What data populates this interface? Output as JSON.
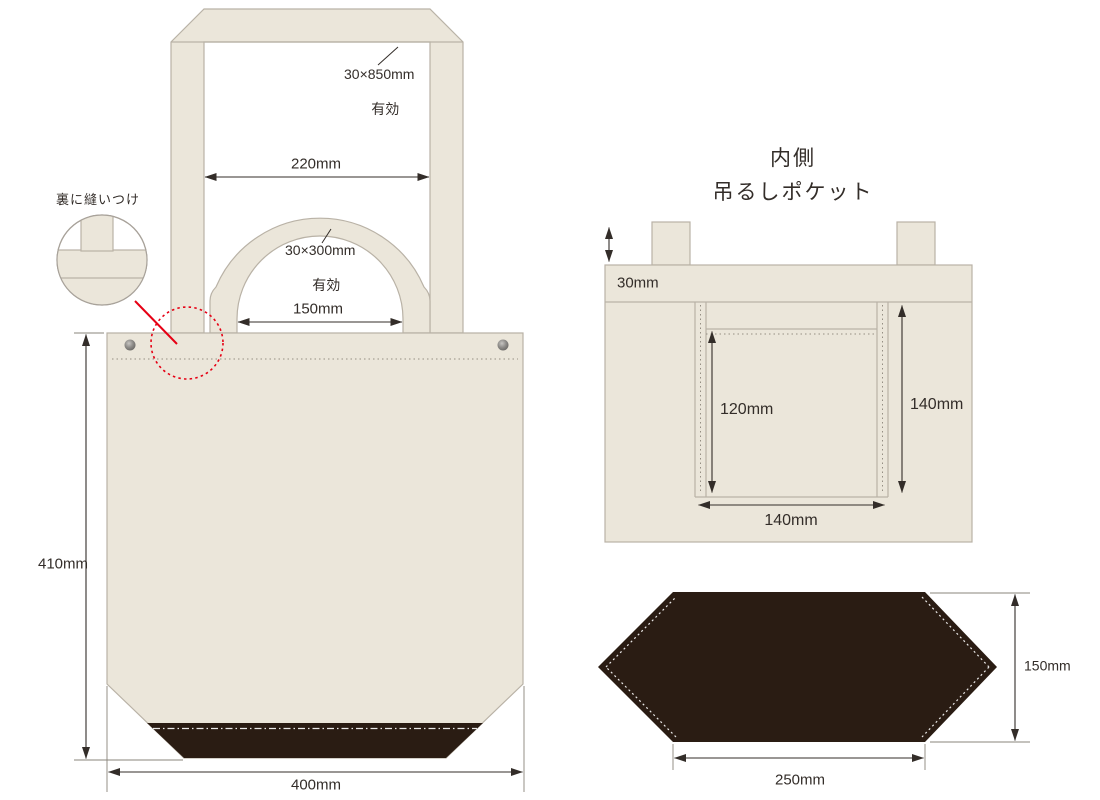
{
  "front_view": {
    "strap_note": {
      "line1": "30×850mm",
      "line2": "有効"
    },
    "handle_note": {
      "line1": "30×300mm",
      "line2": "有効"
    },
    "dim_strap_opening": "220mm",
    "dim_handle_opening": "150mm",
    "dim_bag_height": "410mm",
    "dim_bag_width": "400mm",
    "stitch_note": "裏に縫いつけ"
  },
  "inside_view": {
    "title_line1": "内側",
    "title_line2": "吊るしポケット",
    "dim_fold": "30mm",
    "dim_pocket_depth": "120mm",
    "dim_pocket_height": "140mm",
    "dim_pocket_width": "140mm"
  },
  "bottom_view": {
    "dim_gusset_height": "150mm",
    "dim_gusset_width": "250mm"
  },
  "colors": {
    "canvas": "#ebe6da",
    "canvas-outline": "#b9b2a6",
    "bottom-dark": "#2a1c13",
    "annotation-red": "#e60014",
    "ink": "#332d29"
  }
}
